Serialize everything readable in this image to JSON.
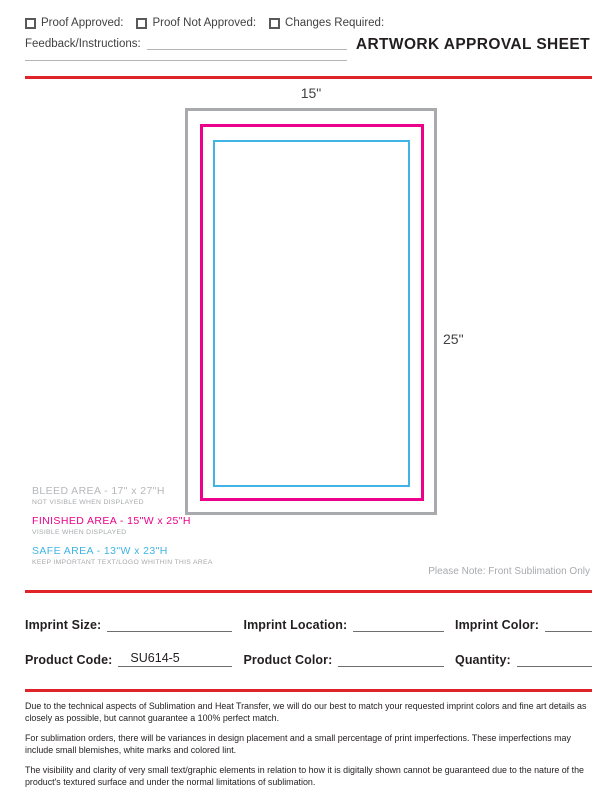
{
  "header": {
    "checkboxes": [
      {
        "label": "Proof Approved:"
      },
      {
        "label": "Proof Not Approved:"
      },
      {
        "label": "Changes Required:"
      }
    ],
    "feedback_label": "Feedback/Instructions:",
    "title": "ARTWORK APPROVAL SHEET"
  },
  "diagram": {
    "width_label": "15\"",
    "height_label": "25\""
  },
  "legend": [
    {
      "title": "BLEED AREA - 17\" x 27\"H",
      "subtitle": "NOT VISIBLE WHEN DISPLAYED",
      "color": "#B5B7BA"
    },
    {
      "title": "FINISHED AREA - 15\"W x 25\"H",
      "subtitle": "VISIBLE WHEN DISPLAYED",
      "color": "#EC008C"
    },
    {
      "title": "SAFE AREA - 13\"W x 23\"H",
      "subtitle": "KEEP IMPORTANT TEXT/LOGO WHITHIN THIS AREA",
      "color": "#3FB4E5"
    }
  ],
  "note": "Please Note: Front Sublimation Only",
  "form": {
    "fields": [
      {
        "label": "Imprint Size:",
        "value": ""
      },
      {
        "label": "Imprint Location:",
        "value": ""
      },
      {
        "label": "Imprint Color:",
        "value": ""
      },
      {
        "label": "Product Code:",
        "value": "SU614-5"
      },
      {
        "label": "Product Color:",
        "value": ""
      },
      {
        "label": "Quantity:",
        "value": ""
      }
    ]
  },
  "disclaimer": [
    "Due to the technical aspects of Sublimation and Heat Transfer, we will do our best to match your requested imprint colors and fine art details as closely as possible, but cannot guarantee a 100% perfect match.",
    "For sublimation orders, there will be variances in design placement and a small percentage of print imperfections. These imperfections may include small blemishes, white marks and colored lint.",
    "The visibility and clarity of very small text/graphic elements in relation to how it is digitally shown cannot be guaranteed due to the nature of the product's textured surface and under the normal limitations of sublimation."
  ],
  "colors": {
    "rule_red": "#DF2328",
    "bleed_gray": "#A8AAAD",
    "finished_magenta": "#EC008C",
    "safe_cyan": "#3FB4E5"
  }
}
